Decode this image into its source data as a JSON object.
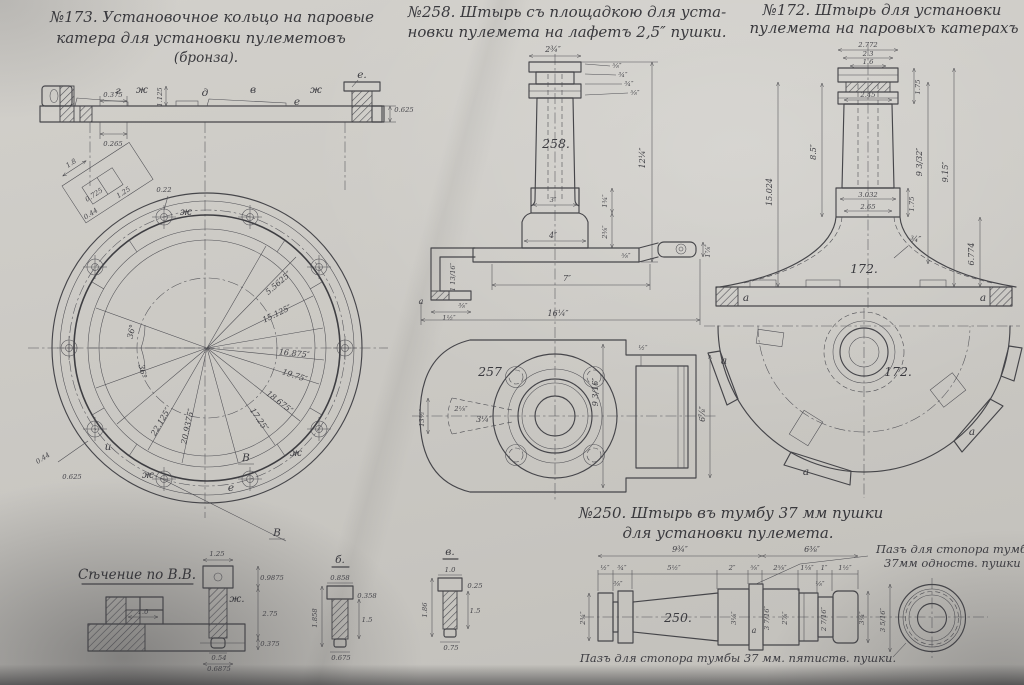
{
  "colors": {
    "paper": "#cbc9c4",
    "ink": "#3c3c41"
  },
  "titles": {
    "t173a": "№173. Установочное кольцо на паровые",
    "t173b": "катера для установки пулеметовъ",
    "t173c": "(бронза).",
    "t258a": "№258. Штырь съ площадкою для уста-",
    "t258b": "новки пулемета на лафетъ 2,5″ пушки.",
    "t172a": "№172. Штырь для установки",
    "t172b": "пулемета на паровыхъ катерахъ",
    "t250a": "№250. Штырь въ тумбу 37 мм пушки",
    "t250b": "для установки пулемета.",
    "sectionBB": "Сѣчение по В.В."
  },
  "ring": {
    "sideLetters": [
      "г",
      "ж",
      "д",
      "в",
      "е",
      "ж"
    ],
    "rightLugLabel": "е.",
    "sideDims": [
      "0.375",
      "0.265",
      "1.125",
      "0.625"
    ],
    "radialDims": [
      "5.5625″",
      "15.125″",
      "16.875″",
      "19.75″",
      "18.675″",
      "17.25″",
      "20.9375″",
      "22.125″"
    ],
    "angles": [
      "36°",
      "36°"
    ],
    "detailDims": [
      "1.8",
      "0.725",
      "0.44",
      "1.25"
    ],
    "holeDim": "0.22",
    "lugDims": [
      "0.44",
      "0.625"
    ],
    "ringLetters": [
      "ж",
      "ж",
      "ж",
      "и",
      "е"
    ],
    "sectionMark": "В"
  },
  "pin258": {
    "num": "258.",
    "planNum": "257",
    "capWidth": "2¾″",
    "capSide": [
      "⅝″",
      "¾″",
      "¾″",
      "⅝″"
    ],
    "height": "12¼″",
    "stepH": "1¾″",
    "baseH": "2⅜″",
    "stepW": "3″",
    "baseW": "4″",
    "armLen": "7″",
    "total": "16¼″",
    "hookH": "1 13/16″",
    "hookT": "⅜″",
    "hookW": "1½″",
    "hookA": "а",
    "plateT": "⅝″",
    "lugW": "1⅞″",
    "planH": "9 3/16″",
    "cavH": "6⅞″",
    "wall": "½″",
    "slotW": "3¼″",
    "slotH": "2⅛″",
    "slotL": "13½″"
  },
  "pin172": {
    "num": "172.",
    "planNum": "172.",
    "topDims": [
      "2.772",
      "2.3",
      "1.6"
    ],
    "collarTop": "2.45",
    "capH": "1.75",
    "leftH": "15.024",
    "shaftH": "8.5″",
    "rightH1": "9 3/32″",
    "rightH2": "9.15″",
    "bellH": "6.774",
    "collarDims": [
      "3.032",
      "2.65"
    ],
    "collarH": "1.75",
    "wall": "¾″",
    "a": "а"
  },
  "shaft250": {
    "num": "250.",
    "a": "а",
    "chainTop": [
      "9¾″",
      "6⅜″"
    ],
    "chain": [
      "½″",
      "¾″",
      "5½″",
      "2″",
      "⅝″",
      "2⅝″",
      "1⅛″",
      "1″",
      "1½″"
    ],
    "vertDims": [
      "2¾″",
      "3⅛″",
      "3 7/16″",
      "2⅞″",
      "2 7/16″",
      "3¼″"
    ],
    "endDia": "3 5/16″",
    "small1": "⅜″",
    "small2": "⅛″",
    "noteTop1": "Пазъ для стопора тумбы",
    "noteTop2": "37мм одноств. пушки",
    "noteBottom": "Пазъ для стопора тумбы 37 мм. пятиств. пушки."
  },
  "sectionBB": {
    "dim": "1.0",
    "boltZh": {
      "label": "ж.",
      "top": "1.25",
      "r1": "0.9875",
      "r2": "2.75",
      "r3": "0.375",
      "b1": "0.54",
      "b2": "0.6875"
    },
    "boltB": {
      "label": "б.",
      "top": "0.858",
      "r1": "0.358",
      "l1": "1.858",
      "r2": "1.5",
      "b1": "0.675"
    },
    "boltV": {
      "label": "в.",
      "top": "1.0",
      "r1": "0.25",
      "l1": "1.86",
      "r2": "1.5",
      "b1": "0.75"
    }
  }
}
